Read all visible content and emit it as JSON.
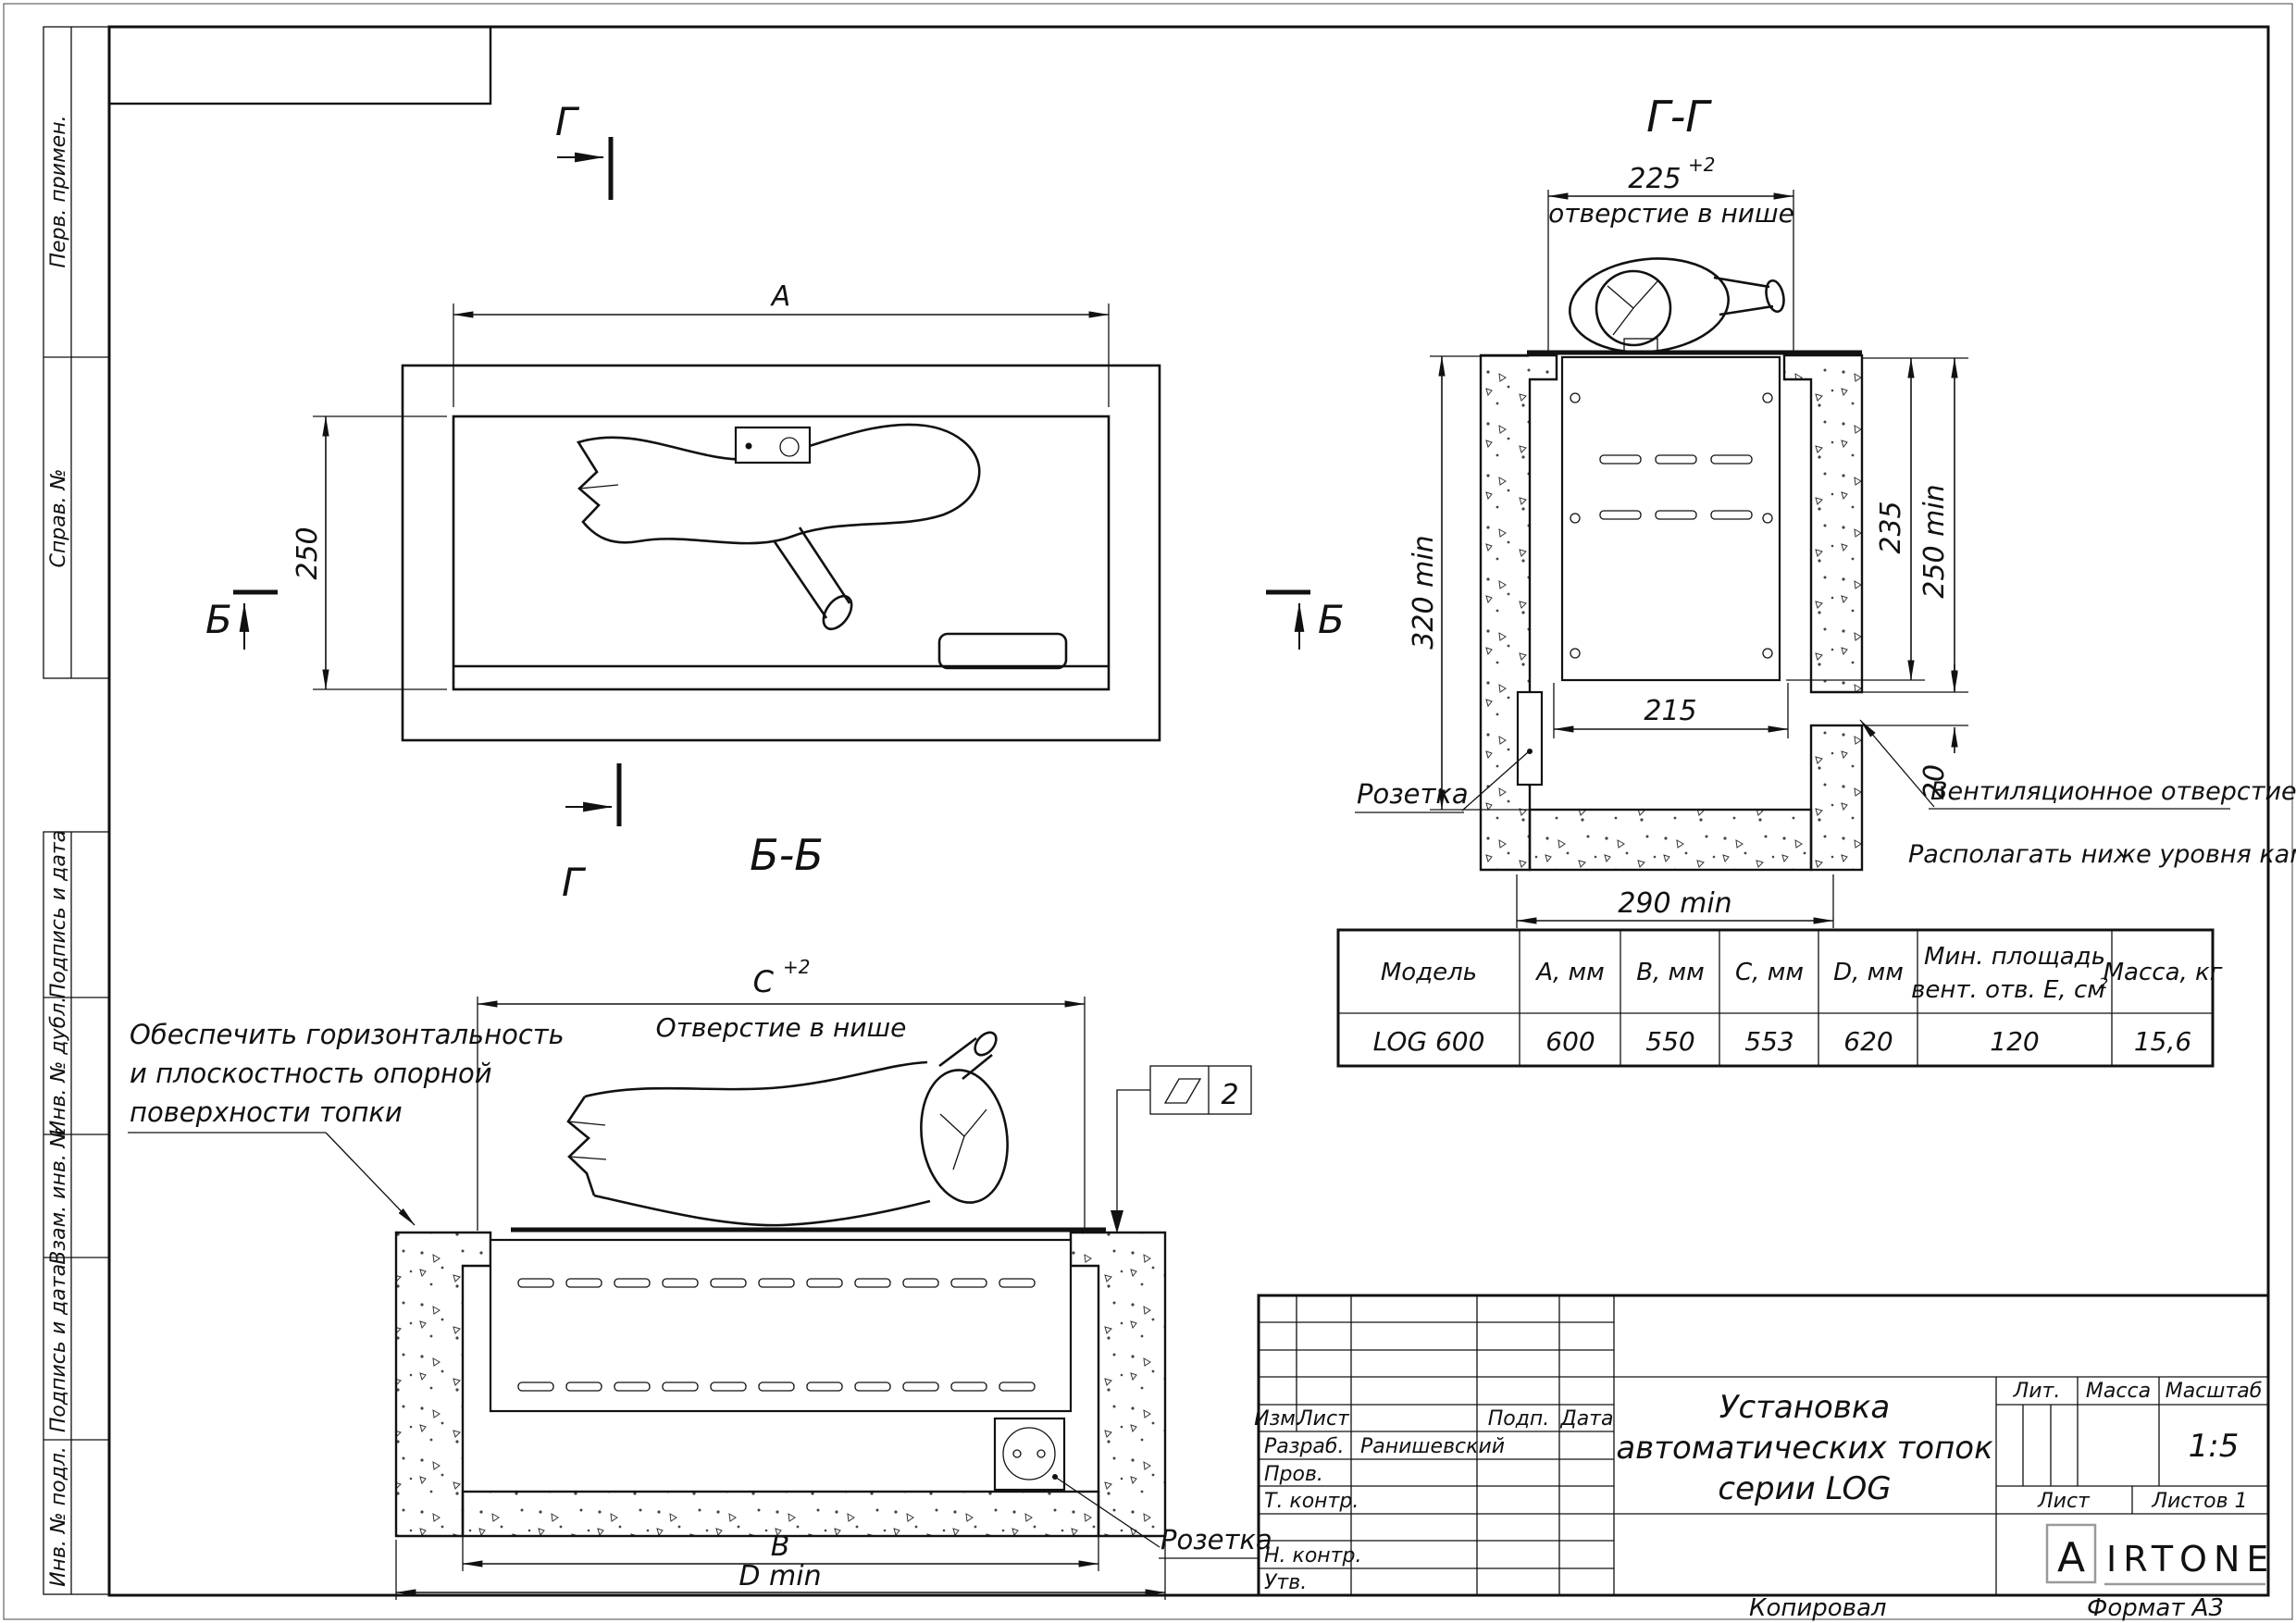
{
  "margins": [
    "Перв. примен.",
    "Справ. №",
    "Подпись и дата",
    "Инв. № дубл.",
    "Взам. инв. №",
    "Подпись и дата",
    "Инв. № подл."
  ],
  "plan": {
    "g": "Г",
    "b": "Б",
    "dim_a": "А",
    "dim_250": "250"
  },
  "gg": {
    "title": "Г-Г",
    "dim_225": "225",
    "sup": "+2",
    "opening": "отверстие в нише",
    "dim_320": "320 min",
    "dim_235": "235",
    "dim_250": "250 min",
    "dim_215": "215",
    "dim_20": "20",
    "dim_290": "290 min",
    "socket": "Розетка",
    "vent1": "Вентиляционное отверстие Е",
    "vent2": "Располагать ниже уровня камина"
  },
  "bb": {
    "title": "Б-Б",
    "dim_c": "С",
    "sup": "+2",
    "opening": "Отверстие в нише",
    "note1": "Обеспечить горизонтальность",
    "note2": "и плоскостность опорной",
    "note3": "поверхности топки",
    "flatness": "2",
    "dim_b": "В",
    "dim_d": "D min",
    "socket": "Розетка"
  },
  "table": {
    "h_model": "Модель",
    "h_a": "А, мм",
    "h_b": "В, мм",
    "h_c": "С, мм",
    "h_d": "D, мм",
    "h_e1": "Мин. площадь",
    "h_e2": "вент. отв. Е, см",
    "h_e_sup": "2",
    "h_m": "Масса, кг",
    "r_model": "LOG 600",
    "r_a": "600",
    "r_b": "550",
    "r_c": "553",
    "r_d": "620",
    "r_e": "120",
    "r_m": "15,6"
  },
  "tb": {
    "izm": "Изм.",
    "list": "Лист",
    "podp": "Подп.",
    "date": "Дата",
    "razrab": "Разраб.",
    "razrab_name": "Ранишевский",
    "prov": "Пров.",
    "tkontr": "Т. контр.",
    "nkontr": "Н. контр.",
    "utv": "Утв.",
    "title1": "Установка",
    "title2": "автоматических топок",
    "title3": "серии LOG",
    "lit": "Лит.",
    "mass": "Масса",
    "scale_label": "Масштаб",
    "scale": "1:5",
    "sheet": "Лист",
    "sheets": "Листов 1",
    "logo_a": "A",
    "logo_rest": "IRTONE",
    "copied": "Копировал",
    "format": "Формат А3"
  }
}
